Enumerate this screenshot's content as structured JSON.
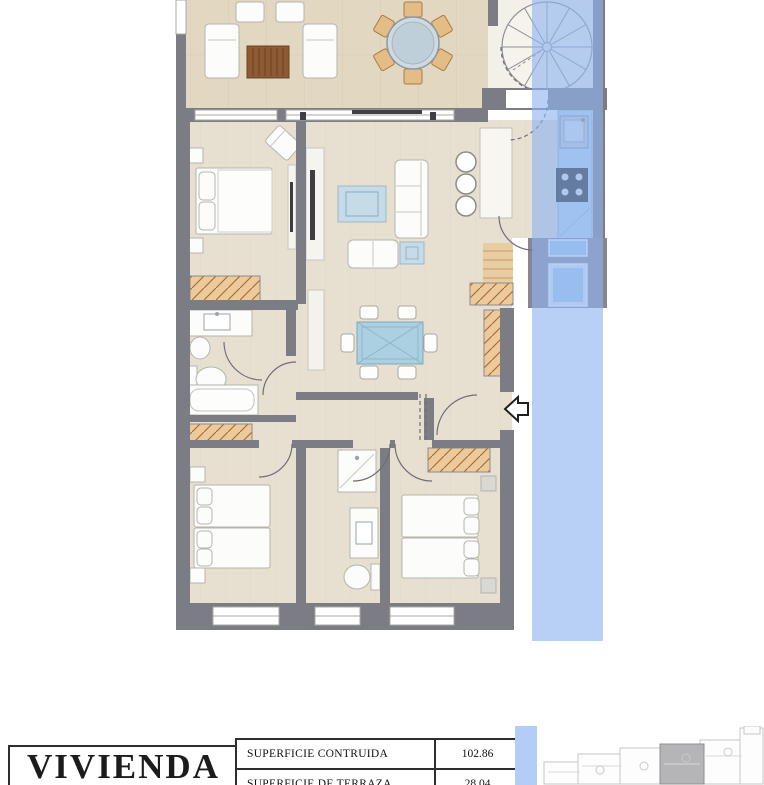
{
  "title_block": {
    "title": "VIVIENDA",
    "rows": [
      {
        "label": "SUPERFICIE CONTRUIDA",
        "value": "102.86"
      },
      {
        "label": "SUPERFICIE DE TERRAZA",
        "value": "28.04"
      }
    ]
  },
  "plan": {
    "type": "apartment-floor-plan",
    "highlight_band": "vertical translucent blue strip over right edge of plan",
    "key_plan_note": "row of unit outlines, one unit shaded"
  },
  "colors": {
    "wall_gray": "#7c7c84",
    "annex_gray": "#878790",
    "floor_interior": "#e7e0d1",
    "floor_terrace": "#e2d8c1",
    "wood_light": "#ecca9b",
    "wood_dark": "#8e5a33",
    "counter_blue": "#bcd9ee",
    "rug_blue": "#c6dbe8",
    "glass_blue": "#abd0e2",
    "stove_black": "#1d1d1d",
    "band_blue": "#8fb4f0",
    "band_solid": "#b4cdf6",
    "keyplan_gray": "#b5b5b7"
  }
}
